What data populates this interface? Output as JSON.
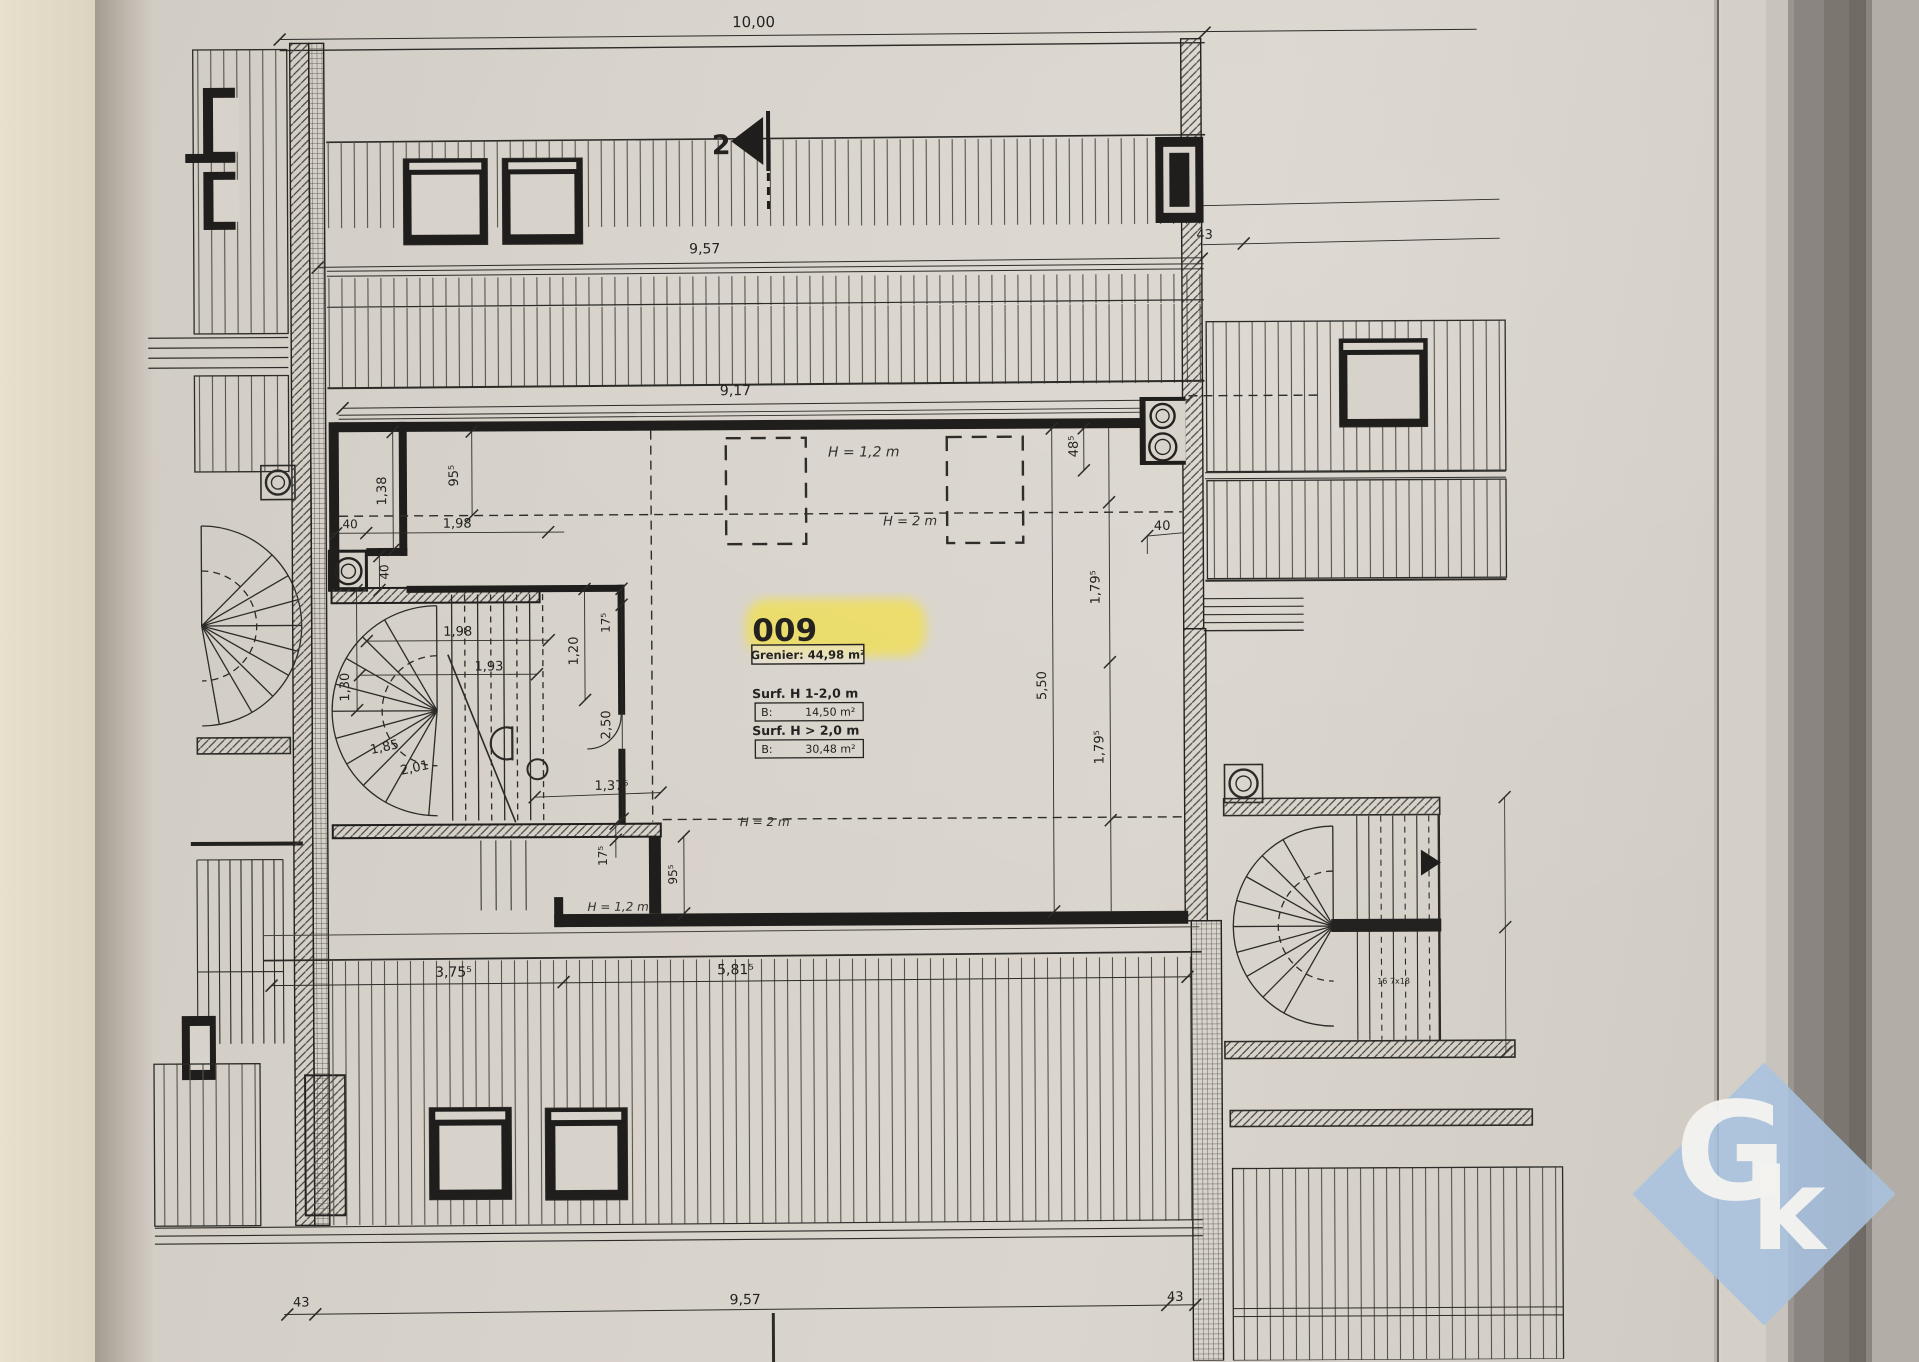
{
  "plan": {
    "section_marker": "2",
    "room": {
      "number": "009",
      "category": "Grenier: 44,98 m²",
      "surface_rows": [
        {
          "label": "Surf. H  1-2,0 m",
          "prefix": "B:",
          "area": "14,50 m²"
        },
        {
          "label": "Surf. H > 2,0 m",
          "prefix": "B:",
          "area": "30,48 m²"
        }
      ]
    },
    "heights": {
      "h12_top": "H = 1,2 m",
      "h2_top": "H = 2 m",
      "h2_bottom": "H = 2 m",
      "h12_bottom": "H = 1,2 m"
    },
    "dims": {
      "top": "10,00",
      "upper": "9,57",
      "upper_right": "43",
      "wall": "9,17",
      "r48": "48⁵",
      "r40": "40",
      "r179a": "1,79⁵",
      "r550": "5,50",
      "r179b": "1,79⁵",
      "l138": "1,38",
      "l955": "95⁵",
      "l40a": "40",
      "l198a": "1,98",
      "l40b": "40",
      "l198b": "1,98",
      "l120": "1,20",
      "l175a": "17⁵",
      "l193": "1,93",
      "l130": "1,30",
      "l250": "2,50",
      "l185": "1,85",
      "l201": "2,01",
      "l1375": "1,37⁵",
      "b175": "17⁵",
      "b955": "95⁵",
      "b375": "3,75⁵",
      "b581": "5,81⁵",
      "f43l": "43",
      "f957": "9,57",
      "f43r": "43",
      "stair_note": "16 7x18"
    }
  },
  "watermark": {
    "letter_g": "G",
    "letter_k": "k",
    "diamond_color": "#a9c3e0"
  },
  "colors": {
    "highlight_yellow": "#f2e04e",
    "paper": "#d7d2ca",
    "ink": "#232220"
  }
}
